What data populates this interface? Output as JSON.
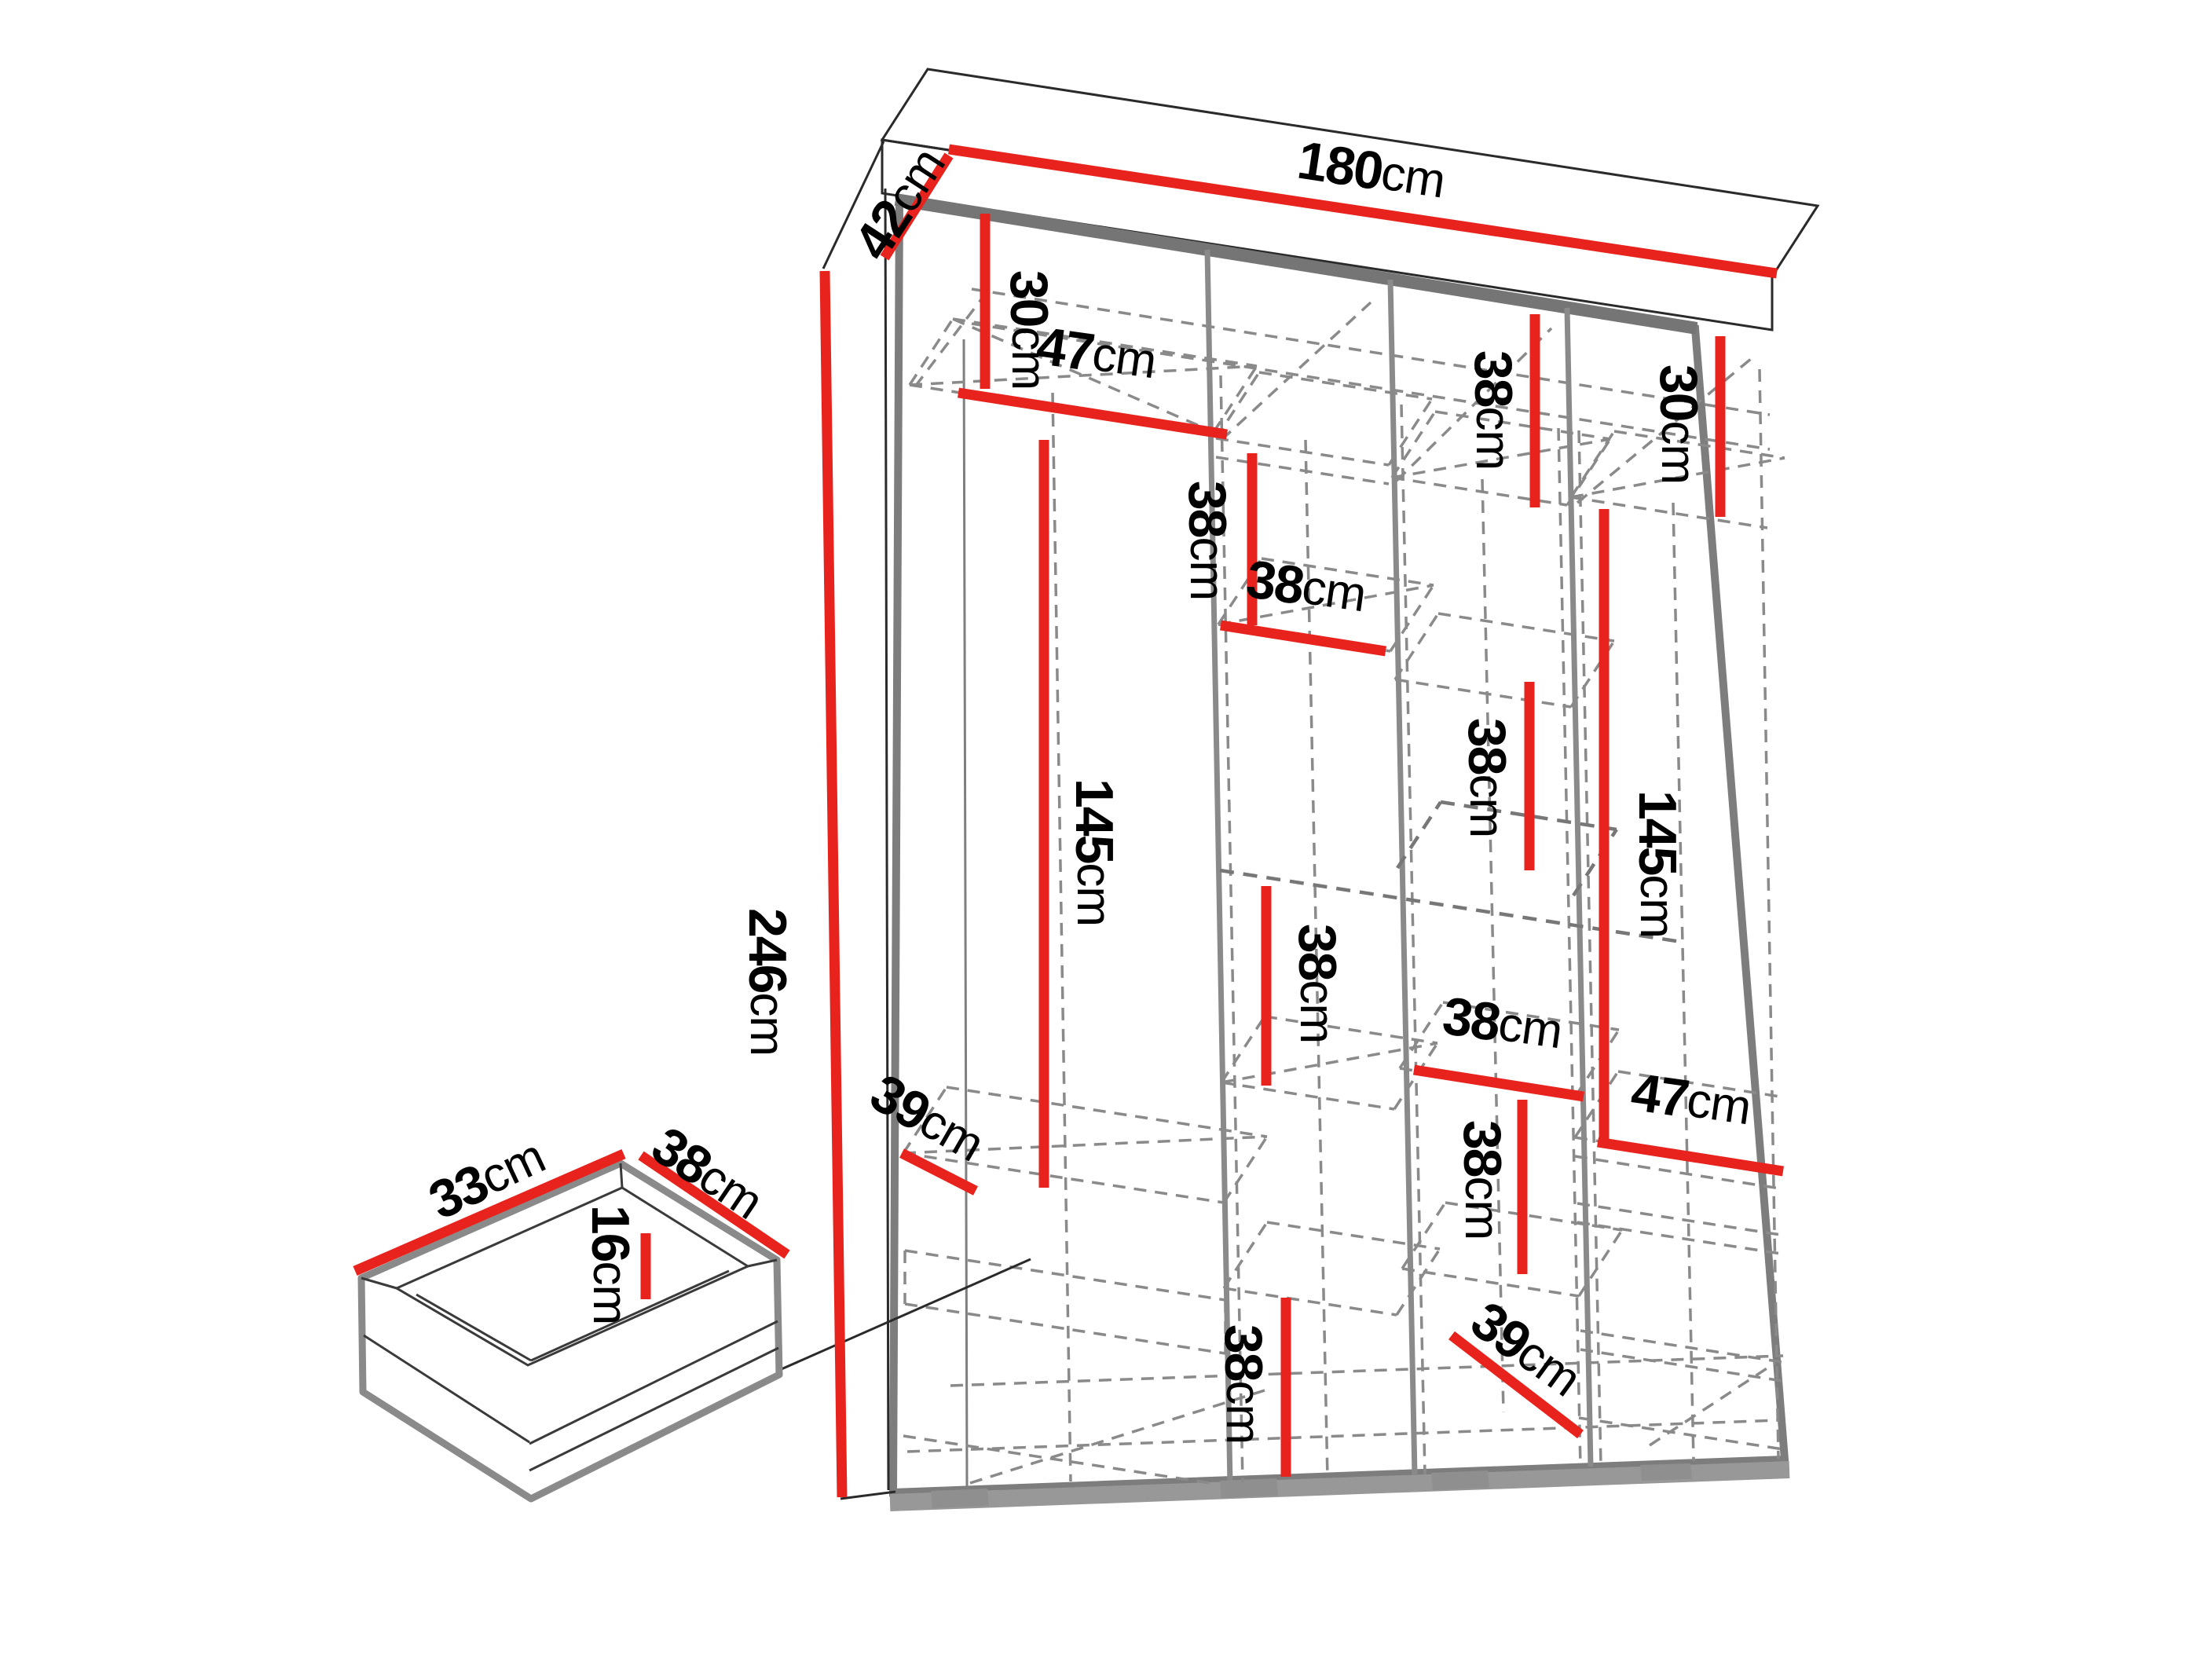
{
  "diagram_type": "wardrobe-dimension-diagram",
  "colors": {
    "dimension_red": "#e8231d",
    "structure_gray": "#7d7d7d",
    "dashed_gray": "#8a8a8a",
    "text_black": "#000000",
    "background": "#ffffff"
  },
  "labels": {
    "w180": {
      "num": "180",
      "unit": "cm"
    },
    "d42": {
      "num": "42",
      "unit": "cm"
    },
    "h246": {
      "num": "246",
      "unit": "cm"
    },
    "c1_30": {
      "num": "30",
      "unit": "cm"
    },
    "c1_47": {
      "num": "47",
      "unit": "cm"
    },
    "c1_145": {
      "num": "145",
      "unit": "cm"
    },
    "c1_39": {
      "num": "39",
      "unit": "cm"
    },
    "c2_38a": {
      "num": "38",
      "unit": "cm"
    },
    "c2_38b": {
      "num": "38",
      "unit": "cm"
    },
    "c2_38c": {
      "num": "38",
      "unit": "cm"
    },
    "c2_38d": {
      "num": "38",
      "unit": "cm"
    },
    "c3_38a": {
      "num": "38",
      "unit": "cm"
    },
    "c3_38b": {
      "num": "38",
      "unit": "cm"
    },
    "c3_38c": {
      "num": "38",
      "unit": "cm"
    },
    "c3_38d": {
      "num": "38",
      "unit": "cm"
    },
    "c3_39": {
      "num": "39",
      "unit": "cm"
    },
    "c4_30": {
      "num": "30",
      "unit": "cm"
    },
    "c4_145": {
      "num": "145",
      "unit": "cm"
    },
    "c4_47": {
      "num": "47",
      "unit": "cm"
    },
    "dr_33": {
      "num": "33",
      "unit": "cm"
    },
    "dr_38": {
      "num": "38",
      "unit": "cm"
    },
    "dr_16": {
      "num": "16",
      "unit": "cm"
    }
  },
  "dimensions_visible": {
    "overall_width": "180cm",
    "overall_depth": "42cm",
    "overall_height": "246cm",
    "section_values": [
      "30cm",
      "47cm",
      "145cm",
      "39cm",
      "38cm"
    ],
    "drawer": {
      "side_depth": "33cm",
      "front_width": "38cm",
      "inner_height": "16cm"
    }
  }
}
